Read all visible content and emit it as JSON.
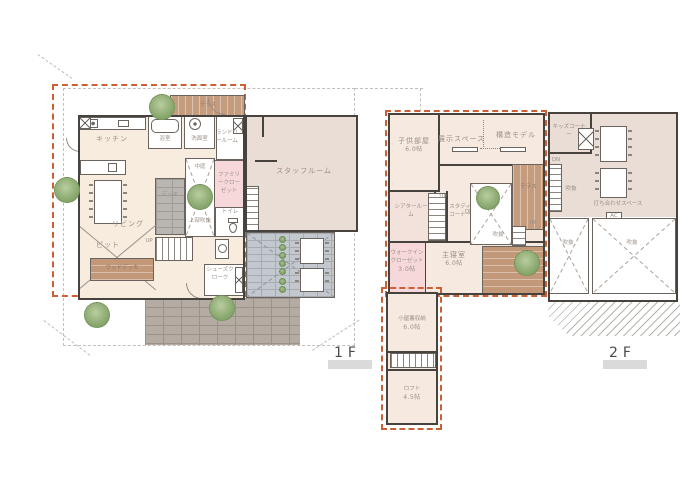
{
  "floors": {
    "f1_label": "1F",
    "f2_label": "2F"
  },
  "colors": {
    "accent_dashed_boundary": "#cc5f34",
    "wall": "#46423e",
    "room_cream": "#f8ecdf",
    "room_pink": "#f7d8da",
    "room_beige_gray": "#e9ddd6",
    "wood_deck": "#c59c7e",
    "gray_brick": "#b9b6b2",
    "tan_brick": "#b4aba2",
    "blue_gray_pave": "#c3c8ce",
    "tree_green": "#8aa96f",
    "label_gray": "#9a9089",
    "floor_label_bar": "#dadada"
  },
  "f1": {
    "terrace": "テラス",
    "kitchen": "キッチン",
    "bath": "浴室",
    "washroom": "洗面室",
    "laundry": "ランドリールーム",
    "family_closet": "ファミリークローゼット",
    "living": "リビング",
    "deck": "デッキ",
    "courtyard": "中庭",
    "courtyard_note": "上部吹抜",
    "toilet": "トイレ",
    "shoes_closet": "シューズクローク",
    "pit": "ピット",
    "wood_deck": "ウッドデッキ",
    "staff_room": "スタッフルーム",
    "up": "UP"
  },
  "f2": {
    "kids_room": "子供部屋",
    "kids_room_size": "6.0帖",
    "exhibit_space": "展示スペース",
    "structure_model": "構造モデル",
    "kids_corner": "キッズコーナー",
    "theater_room": "シアタールーム",
    "study_corner": "スタディコーナー",
    "void": "吹抜",
    "terrace": "テラス",
    "meeting_space": "打ち合わせスペース",
    "walk_in_closet": "ウォークインクローゼット",
    "walk_in_closet_size": "3.0帖",
    "master_bedroom": "主寝室",
    "master_bedroom_size": "6.0帖",
    "attic_storage": "小屋裏収納",
    "attic_storage_size": "6.0帖",
    "loft": "ロフト",
    "loft_size": "4.5帖",
    "up": "UP",
    "dn": "DN",
    "ac": "AC"
  }
}
